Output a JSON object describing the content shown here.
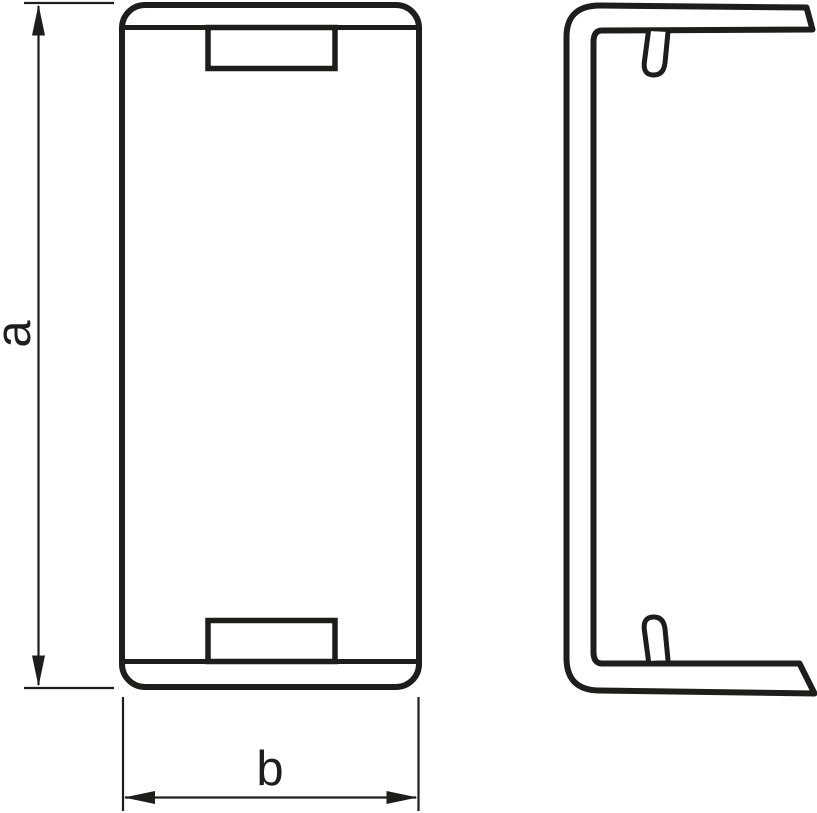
{
  "page": {
    "background_color": "#ffffff",
    "line_color": "#1d1d1b"
  },
  "drawing": {
    "dimension_a": {
      "label": "a"
    },
    "dimension_b": {
      "label": "b"
    }
  }
}
